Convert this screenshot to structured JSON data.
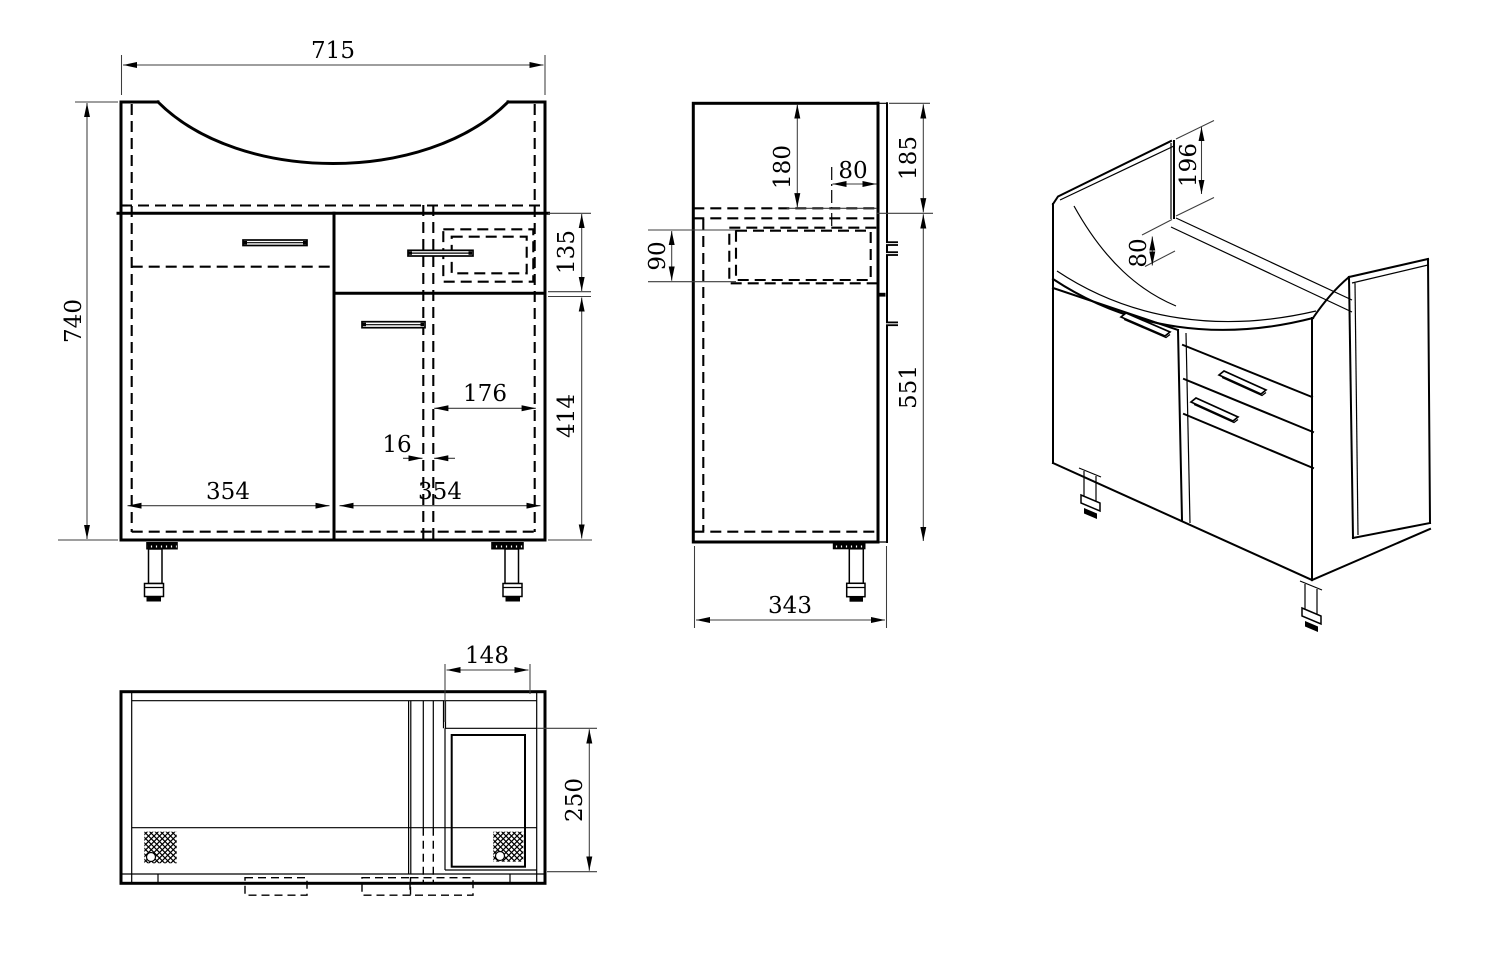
{
  "drawing": {
    "front": {
      "width": "715",
      "height": "740",
      "drawer_front_height": "135",
      "lower_section_height": "414",
      "drawer_inner_offset": "176",
      "partition_gap": "16",
      "left_door_width": "354",
      "right_door_width": "354"
    },
    "side": {
      "basin_inner_depth": "180",
      "back_top_offset": "80",
      "top_section_height": "185",
      "drawer_side_height": "90",
      "body_side_height": "551",
      "cabinet_depth": "343"
    },
    "isometric": {
      "back_edge_height": "196",
      "back_rail_height": "80"
    },
    "bottom": {
      "recess_width": "148",
      "recess_depth": "250"
    }
  }
}
